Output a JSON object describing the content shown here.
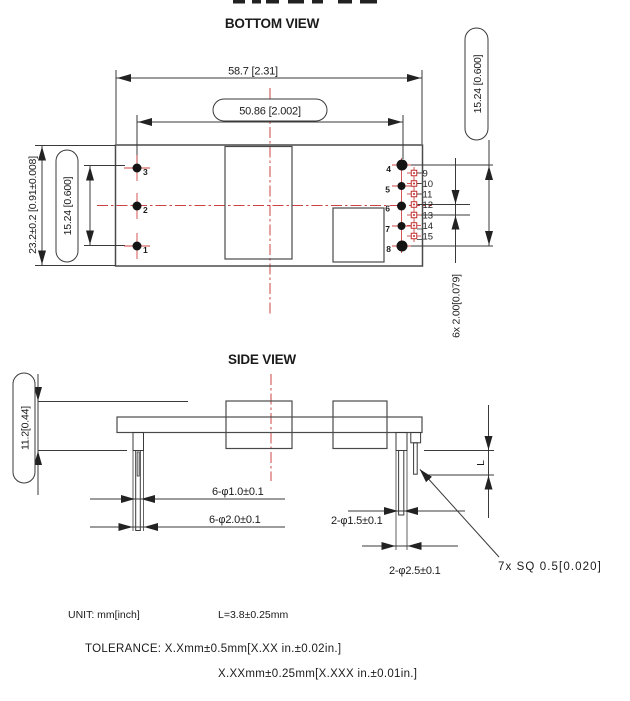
{
  "bottom_view": {
    "title": "BOTTOM VIEW",
    "dims": {
      "outer_width": "58.7 [2.31]",
      "pin_span_width": "50.86 [2.002]",
      "outer_height": "23.2±0.2 [0.91±0.008]",
      "pin_span_left": "15.24 [0.600]",
      "pin_span_right": "15.24 [0.600]",
      "pin_pitch": "6x  2.00[0.079]"
    },
    "pins_left": [
      "3",
      "2",
      "1"
    ],
    "pins_right": [
      "4",
      "5",
      "6",
      "7",
      "8"
    ],
    "pins_io": [
      "9",
      "10",
      "11",
      "12",
      "13",
      "14",
      "15"
    ]
  },
  "side_view": {
    "title": "SIDE VIEW",
    "dims": {
      "module_height": "11.2[0.44]",
      "pin_tip_dia": "6-φ1.0±0.1",
      "pin_base_dia": "6-φ2.0±0.1",
      "pin2_tip_dia": "2-φ1.5±0.1",
      "pin2_base_dia": "2-φ2.5±0.1",
      "square_pin": "7x SQ 0.5[0.020]",
      "pin_length_label": "L"
    }
  },
  "notes": {
    "unit": "UNIT:  mm[inch]",
    "l_value": "L=3.8±0.25mm",
    "tolerance_line1": "TOLERANCE:  X.Xmm±0.5mm[X.XX  in.±0.02in.]",
    "tolerance_line2": "X.XXmm±0.25mm[X.XXX  in.±0.01in.]"
  },
  "colors": {
    "line": "#3a3a3a",
    "centerline_red": "#cc4343",
    "io_pin_red": "#c03030",
    "pin_black": "#141414"
  }
}
